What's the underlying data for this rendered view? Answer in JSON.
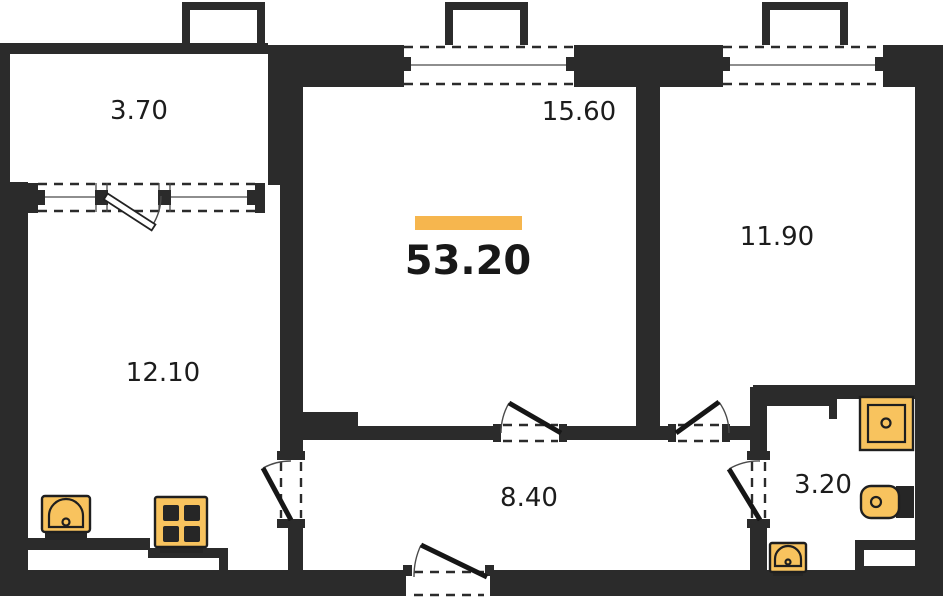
{
  "floor_plan": {
    "total_area": "53.20",
    "rooms": [
      {
        "name": "balcony",
        "area": "3.70"
      },
      {
        "name": "living-room",
        "area": "15.60"
      },
      {
        "name": "bedroom",
        "area": "11.90"
      },
      {
        "name": "kitchen",
        "area": "12.10"
      },
      {
        "name": "hallway",
        "area": "8.40"
      },
      {
        "name": "bathroom",
        "area": "3.20"
      }
    ],
    "fixtures": [
      "kitchen-sink",
      "stove",
      "shower",
      "toilet",
      "bathroom-sink"
    ],
    "colors": {
      "wall": "#2b2b2b",
      "accent": "#f6b64e",
      "fixture": "#f8c35e",
      "fixture-stroke": "#1f1f1f",
      "background": "#ffffff",
      "text": "#1c1c1c"
    }
  }
}
